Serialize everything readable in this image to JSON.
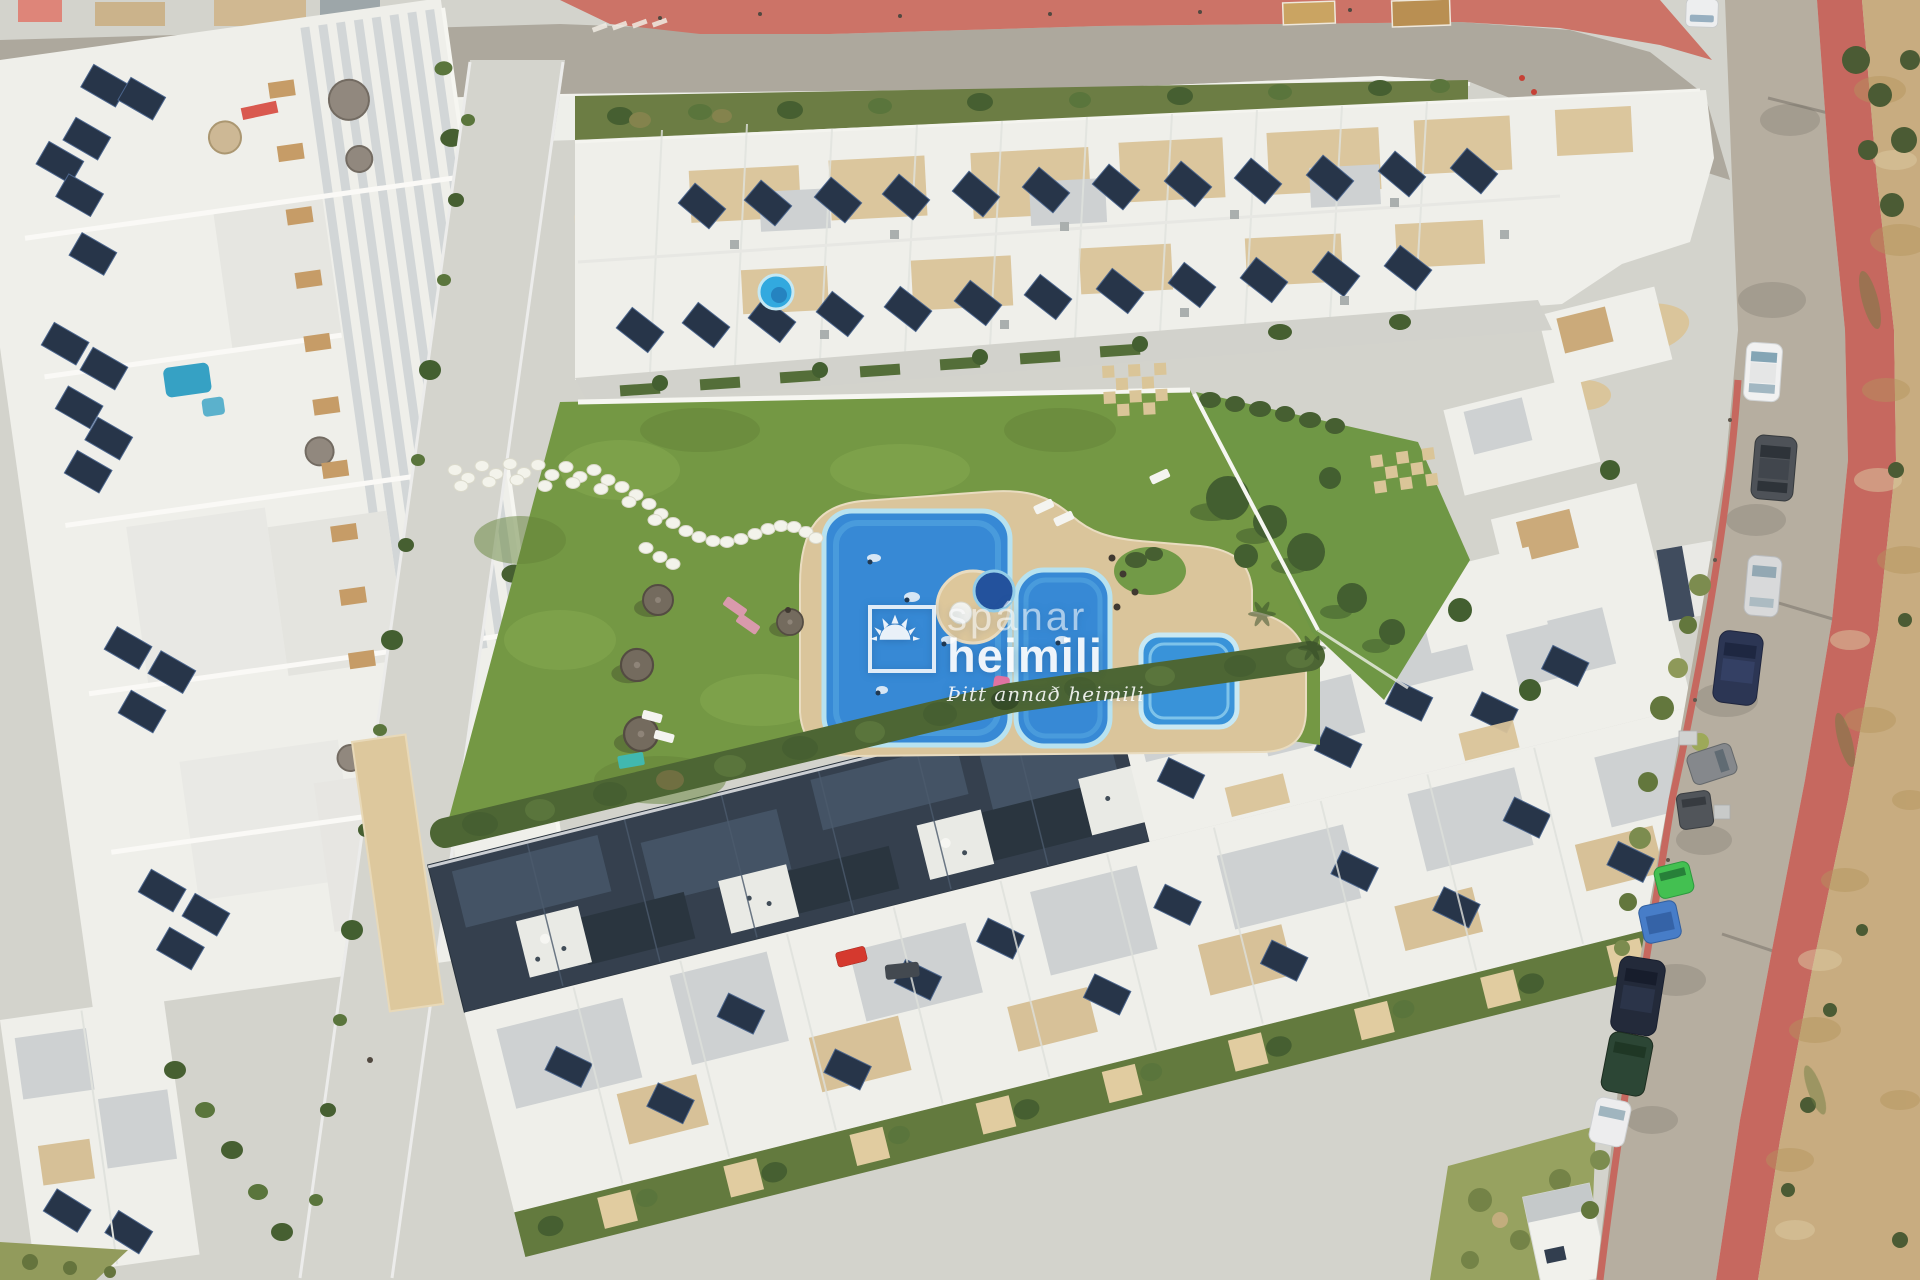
{
  "image": {
    "kind": "aerial-drone-photograph",
    "subject": "Top-down aerial view of a white residential complex with communal lawn, swimming pools, rooftop solar panels, a curving access road with parked cars and sandy scrubland",
    "orientation": "top-down"
  },
  "watermark": {
    "brand_line1": "spánar",
    "brand_line2": "heimili",
    "tagline": "Þitt annað heimili",
    "icon": "sun-icon",
    "color": "#ffffff"
  },
  "palette": {
    "pavement": "#d2d3cd",
    "asphalt_road": "#aaa69c",
    "red_sidewalk": "#c4635b",
    "red_promenade": "#ca6f63",
    "sand": "#c6aa7d",
    "lawn": "#6f953f",
    "hedge": "#46612e",
    "pool_water": "#2f86d6",
    "pool_rim": "#bfe3f1",
    "round_pool_deep": "#1b4d9c",
    "paving_tan": "#d9c499",
    "building_white": "#eff0ec",
    "roof_gray": "#ccd1d3",
    "navy_roof": "#2d3a49",
    "solar_panel": "#1f2e44"
  },
  "scene_labels": {
    "main_pool": "main swimming pool",
    "second_pool": "secondary pool lobe",
    "kids_pool": "children's square pool",
    "round_pool": "round splash pool",
    "garden": "communal lawn garden",
    "stepping_stones": "white stepping-stone path",
    "umbrellas": "sun umbrellas and loungers",
    "access_road": "curving access road",
    "parked_car_colors": [
      "white van",
      "white",
      "dark gray",
      "silver",
      "dark blue",
      "gray",
      "dark gray",
      "green",
      "blue",
      "navy",
      "dark green",
      "white"
    ],
    "scrubland": "undeveloped sandy scrubland",
    "solar_panels": "rooftop solar panels",
    "apartments_left": "white apartment blocks",
    "townhouses_top": "townhouse rooftops",
    "navy_block": "dark-roofed apartment row"
  }
}
